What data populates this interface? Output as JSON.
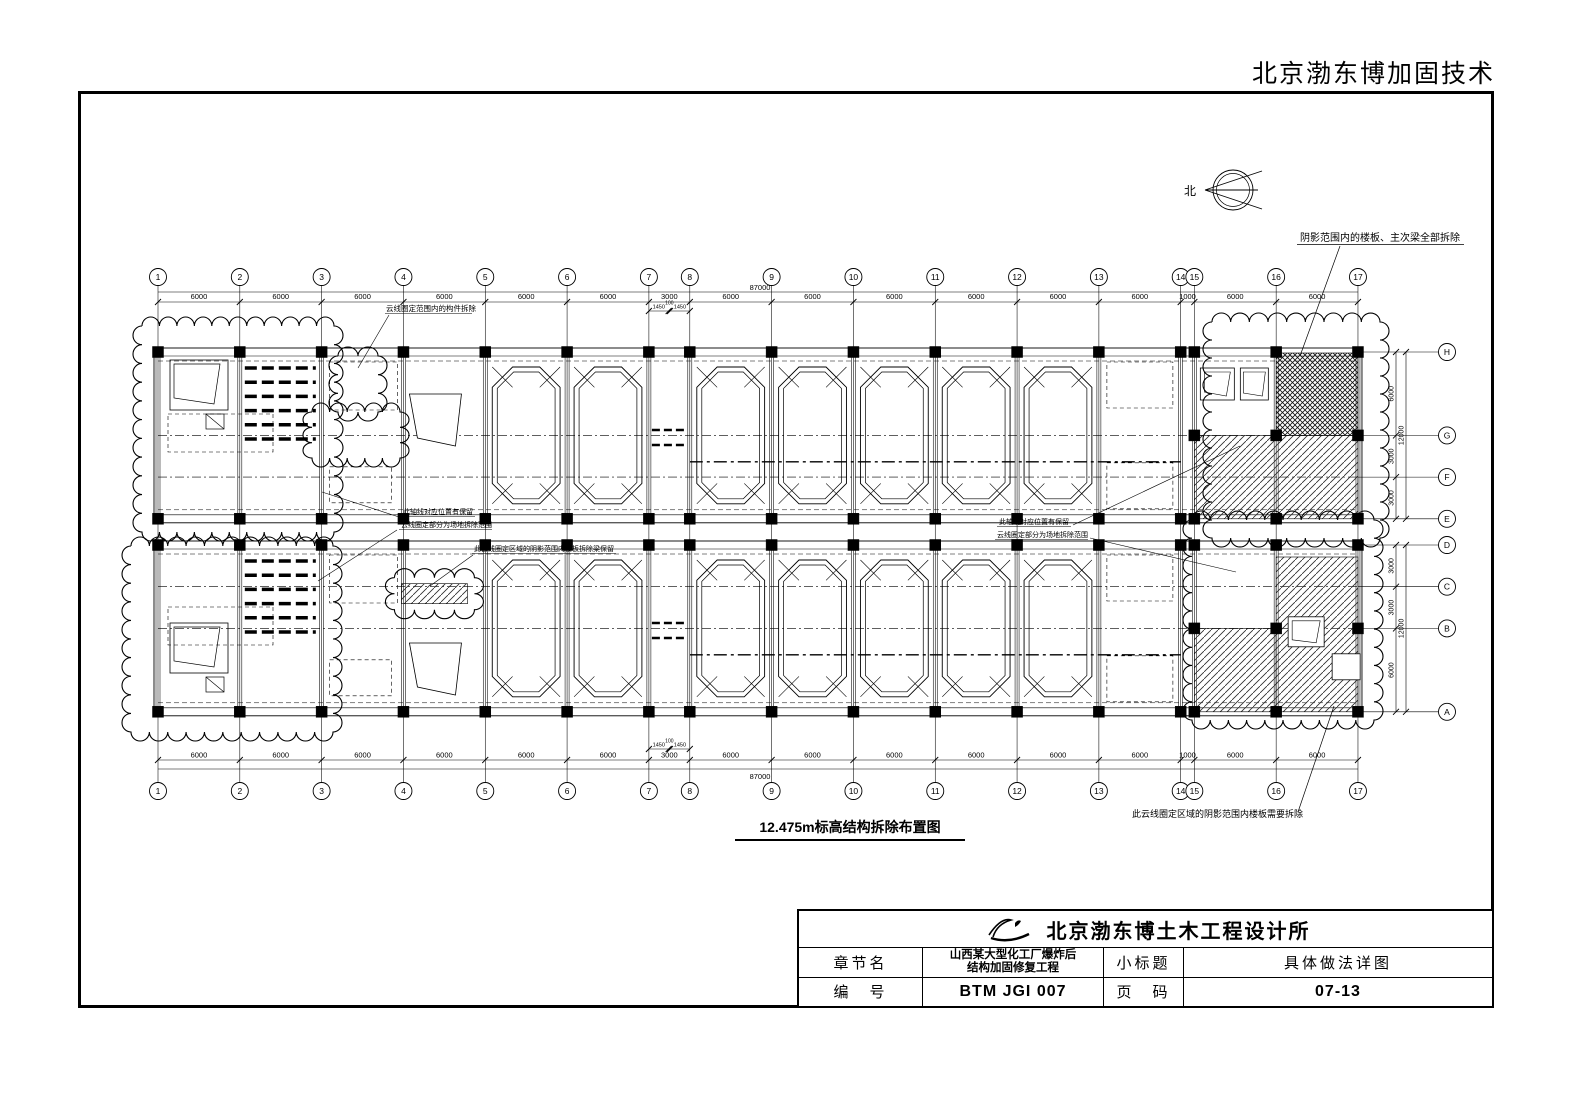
{
  "header": {
    "brand": "北京渤东博加固技术"
  },
  "north": {
    "label": "北"
  },
  "drawing": {
    "title": "12.475m标高结构拆除布置图",
    "grid": {
      "col_labels": [
        "1",
        "2",
        "3",
        "4",
        "5",
        "6",
        "7",
        "8",
        "9",
        "10",
        "11",
        "12",
        "13",
        "14",
        "15",
        "16",
        "17"
      ],
      "col_spacings_mm": [
        6000,
        6000,
        6000,
        6000,
        6000,
        6000,
        3000,
        6000,
        6000,
        6000,
        6000,
        6000,
        6000,
        1000,
        6000,
        6000
      ],
      "total_mm": "87000",
      "sub_dims": [
        "1450",
        "100",
        "1450"
      ],
      "row_labels_upper": [
        "H",
        "G",
        "F",
        "E"
      ],
      "row_spacings_upper_mm": [
        6000,
        3000,
        3000
      ],
      "row_total_upper": "12000",
      "row_labels_lower": [
        "D",
        "C",
        "B",
        "A"
      ],
      "row_spacings_lower_mm": [
        3000,
        3000,
        6000
      ],
      "row_total_lower": "12000"
    },
    "annotations": {
      "shaded_note": "阴影范围内的楼板、主次梁全部拆除",
      "cloud_note_top": "云线圈定范围内的构件拆除",
      "axis_keep_line1": "此轴线对应位置有保留",
      "axis_keep_line2": "云线圈定部分为场地拆除范围",
      "strip_note": "此云线圈定区域的阴影范围内楼板拆除梁保留",
      "bottom_note": "此云线圈定区域的阴影范围内楼板需要拆除"
    }
  },
  "titleblock": {
    "company": "北京渤东博土木工程设计所",
    "row1_label": "章节名",
    "row1_value_line1": "山西某大型化工厂爆炸后",
    "row1_value_line2": "结构加固修复工程",
    "row1_label2": "小标题",
    "row1_value2": "具体做法详图",
    "row2_label": "编　号",
    "row2_value": "BTM JGI 007",
    "row2_label2": "页　码",
    "row2_value2": "07-13"
  }
}
